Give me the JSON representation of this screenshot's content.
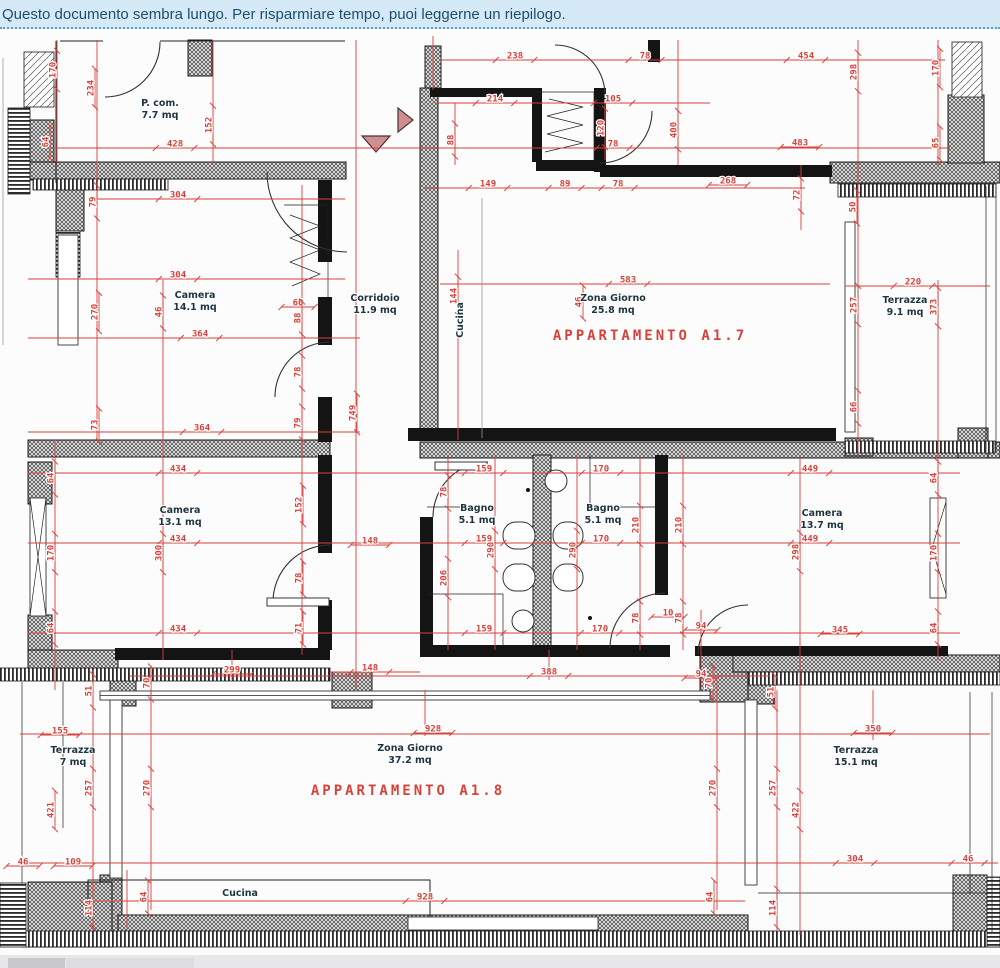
{
  "banner": {
    "text": "Questo documento sembra lungo. Per risparmiare tempo, puoi leggerne un riepilogo."
  },
  "colors": {
    "red": "#d9403a",
    "room_text": "#1d3540",
    "banner_bg": "#d6e9f7",
    "banner_text": "#1d4e6e",
    "banner_border": "#5b9fce",
    "triangle": "#cf8f8f"
  },
  "plan": {
    "apartments": [
      {
        "label": "APPARTAMENTO A1.7",
        "x": 650,
        "y": 340
      },
      {
        "label": "APPARTAMENTO A1.8",
        "x": 408,
        "y": 795
      }
    ],
    "rooms": [
      {
        "name": "P. com.",
        "area": "7.7 mq",
        "x": 160,
        "y": 106,
        "vert": false
      },
      {
        "name": "Camera",
        "area": "14.1 mq",
        "x": 195,
        "y": 298,
        "vert": false
      },
      {
        "name": "Corridoio",
        "area": "11.9 mq",
        "x": 375,
        "y": 301,
        "vert": false
      },
      {
        "name": "Cucina",
        "area": "",
        "x": 463,
        "y": 320,
        "vert": true
      },
      {
        "name": "Zona Giorno",
        "area": "25.8 mq",
        "x": 613,
        "y": 301,
        "vert": false
      },
      {
        "name": "Terrazza",
        "area": "9.1 mq",
        "x": 905,
        "y": 303,
        "vert": false
      },
      {
        "name": "Camera",
        "area": "13.1 mq",
        "x": 180,
        "y": 513,
        "vert": false
      },
      {
        "name": "Bagno",
        "area": "5.1 mq",
        "x": 477,
        "y": 511,
        "vert": false
      },
      {
        "name": "Bagno",
        "area": "5.1 mq",
        "x": 603,
        "y": 511,
        "vert": false
      },
      {
        "name": "Camera",
        "area": "13.7 mq",
        "x": 822,
        "y": 516,
        "vert": false
      },
      {
        "name": "Terrazza",
        "area": "7 mq",
        "x": 73,
        "y": 753,
        "vert": false
      },
      {
        "name": "Zona Giorno",
        "area": "37.2 mq",
        "x": 410,
        "y": 751,
        "vert": false
      },
      {
        "name": "Terrazza",
        "area": "15.1 mq",
        "x": 856,
        "y": 753,
        "vert": false
      },
      {
        "name": "Cucina",
        "area": "",
        "x": 240,
        "y": 896,
        "vert": false
      }
    ],
    "dims": [
      {
        "v": "170",
        "x": 57,
        "y": 70,
        "r": 90
      },
      {
        "v": "234",
        "x": 95,
        "y": 88,
        "r": 90
      },
      {
        "v": "152",
        "x": 213,
        "y": 125,
        "r": 90
      },
      {
        "v": "428",
        "x": 175,
        "y": 148,
        "r": 0
      },
      {
        "v": "64",
        "x": 50,
        "y": 142,
        "r": 90
      },
      {
        "v": "304",
        "x": 178,
        "y": 199,
        "r": 0
      },
      {
        "v": "79",
        "x": 97,
        "y": 202,
        "r": 90
      },
      {
        "v": "238",
        "x": 515,
        "y": 60,
        "r": 0
      },
      {
        "v": "78",
        "x": 645,
        "y": 60,
        "r": 0
      },
      {
        "v": "214",
        "x": 495,
        "y": 103,
        "r": 0
      },
      {
        "v": "105",
        "x": 613,
        "y": 103,
        "r": 0
      },
      {
        "v": "88",
        "x": 455,
        "y": 140,
        "r": 90
      },
      {
        "v": "120",
        "x": 605,
        "y": 128,
        "r": 90
      },
      {
        "v": "78",
        "x": 613,
        "y": 148,
        "r": 0
      },
      {
        "v": "149",
        "x": 488,
        "y": 188,
        "r": 0
      },
      {
        "v": "89",
        "x": 565,
        "y": 188,
        "r": 0
      },
      {
        "v": "78",
        "x": 618,
        "y": 188,
        "r": 0
      },
      {
        "v": "454",
        "x": 806,
        "y": 60,
        "r": 0
      },
      {
        "v": "298",
        "x": 858,
        "y": 72,
        "r": 90
      },
      {
        "v": "170",
        "x": 940,
        "y": 68,
        "r": 90
      },
      {
        "v": "400",
        "x": 678,
        "y": 130,
        "r": 90
      },
      {
        "v": "483",
        "x": 800,
        "y": 147,
        "r": 0
      },
      {
        "v": "65",
        "x": 940,
        "y": 143,
        "r": 90
      },
      {
        "v": "268",
        "x": 728,
        "y": 185,
        "r": 0
      },
      {
        "v": "72",
        "x": 801,
        "y": 195,
        "r": 90
      },
      {
        "v": "50",
        "x": 857,
        "y": 207,
        "r": 90
      },
      {
        "v": "304",
        "x": 178,
        "y": 279,
        "r": 0
      },
      {
        "v": "270",
        "x": 99,
        "y": 312,
        "r": 90
      },
      {
        "v": "46",
        "x": 163,
        "y": 312,
        "r": 90
      },
      {
        "v": "60",
        "x": 298,
        "y": 307,
        "r": 0
      },
      {
        "v": "88",
        "x": 302,
        "y": 318,
        "r": 90
      },
      {
        "v": "364",
        "x": 200,
        "y": 338,
        "r": 0
      },
      {
        "v": "78",
        "x": 302,
        "y": 372,
        "r": 90
      },
      {
        "v": "79",
        "x": 302,
        "y": 423,
        "r": 90
      },
      {
        "v": "73",
        "x": 99,
        "y": 425,
        "r": 90
      },
      {
        "v": "364",
        "x": 202,
        "y": 432,
        "r": 0
      },
      {
        "v": "749",
        "x": 357,
        "y": 413,
        "r": 90
      },
      {
        "v": "583",
        "x": 628,
        "y": 284,
        "r": 0
      },
      {
        "v": "144",
        "x": 458,
        "y": 296,
        "r": 90
      },
      {
        "v": "46",
        "x": 583,
        "y": 302,
        "r": 90
      },
      {
        "v": "220",
        "x": 913,
        "y": 286,
        "r": 0
      },
      {
        "v": "257",
        "x": 858,
        "y": 305,
        "r": 90
      },
      {
        "v": "373",
        "x": 938,
        "y": 307,
        "r": 90
      },
      {
        "v": "66",
        "x": 858,
        "y": 407,
        "r": 90
      },
      {
        "v": "434",
        "x": 178,
        "y": 473,
        "r": 0
      },
      {
        "v": "64",
        "x": 55,
        "y": 478,
        "r": 90
      },
      {
        "v": "159",
        "x": 484,
        "y": 473,
        "r": 0
      },
      {
        "v": "170",
        "x": 601,
        "y": 473,
        "r": 0
      },
      {
        "v": "449",
        "x": 810,
        "y": 473,
        "r": 0
      },
      {
        "v": "64",
        "x": 938,
        "y": 478,
        "r": 90
      },
      {
        "v": "78",
        "x": 448,
        "y": 492,
        "r": 90
      },
      {
        "v": "152",
        "x": 303,
        "y": 505,
        "r": 90
      },
      {
        "v": "210",
        "x": 640,
        "y": 525,
        "r": 90
      },
      {
        "v": "210",
        "x": 683,
        "y": 525,
        "r": 90
      },
      {
        "v": "434",
        "x": 178,
        "y": 543,
        "r": 0
      },
      {
        "v": "300",
        "x": 163,
        "y": 553,
        "r": 90
      },
      {
        "v": "170",
        "x": 55,
        "y": 553,
        "r": 90
      },
      {
        "v": "159",
        "x": 484,
        "y": 543,
        "r": 0
      },
      {
        "v": "170",
        "x": 601,
        "y": 543,
        "r": 0
      },
      {
        "v": "290",
        "x": 495,
        "y": 550,
        "r": 90
      },
      {
        "v": "290",
        "x": 577,
        "y": 550,
        "r": 90
      },
      {
        "v": "449",
        "x": 810,
        "y": 543,
        "r": 0
      },
      {
        "v": "298",
        "x": 800,
        "y": 552,
        "r": 90
      },
      {
        "v": "170",
        "x": 938,
        "y": 553,
        "r": 90
      },
      {
        "v": "148",
        "x": 370,
        "y": 545,
        "r": 0
      },
      {
        "v": "206",
        "x": 448,
        "y": 578,
        "r": 90
      },
      {
        "v": "78",
        "x": 303,
        "y": 578,
        "r": 90
      },
      {
        "v": "71",
        "x": 303,
        "y": 628,
        "r": 90
      },
      {
        "v": "64",
        "x": 55,
        "y": 628,
        "r": 90
      },
      {
        "v": "434",
        "x": 178,
        "y": 633,
        "r": 0
      },
      {
        "v": "159",
        "x": 484,
        "y": 633,
        "r": 0
      },
      {
        "v": "170",
        "x": 600,
        "y": 633,
        "r": 0
      },
      {
        "v": "78",
        "x": 640,
        "y": 618,
        "r": 90
      },
      {
        "v": "10",
        "x": 668,
        "y": 617,
        "r": 0
      },
      {
        "v": "78",
        "x": 683,
        "y": 618,
        "r": 90
      },
      {
        "v": "64",
        "x": 938,
        "y": 628,
        "r": 90
      },
      {
        "v": "94",
        "x": 701,
        "y": 630,
        "r": 0
      },
      {
        "v": "345",
        "x": 840,
        "y": 634,
        "r": 0
      },
      {
        "v": "299",
        "x": 232,
        "y": 674,
        "r": 0
      },
      {
        "v": "148",
        "x": 370,
        "y": 672,
        "r": 0
      },
      {
        "v": "388",
        "x": 549,
        "y": 676,
        "r": 0
      },
      {
        "v": "94",
        "x": 701,
        "y": 678,
        "r": 0
      },
      {
        "v": "51",
        "x": 93,
        "y": 691,
        "r": 90
      },
      {
        "v": "70",
        "x": 151,
        "y": 683,
        "r": 90
      },
      {
        "v": "70",
        "x": 713,
        "y": 683,
        "r": 90
      },
      {
        "v": "51",
        "x": 775,
        "y": 692,
        "r": 90
      },
      {
        "v": "155",
        "x": 60,
        "y": 735,
        "r": 0
      },
      {
        "v": "928",
        "x": 433,
        "y": 733,
        "r": 0
      },
      {
        "v": "350",
        "x": 873,
        "y": 733,
        "r": 0
      },
      {
        "v": "257",
        "x": 93,
        "y": 788,
        "r": 90
      },
      {
        "v": "270",
        "x": 151,
        "y": 788,
        "r": 90
      },
      {
        "v": "421",
        "x": 55,
        "y": 810,
        "r": 90
      },
      {
        "v": "270",
        "x": 717,
        "y": 788,
        "r": 90
      },
      {
        "v": "257",
        "x": 777,
        "y": 788,
        "r": 90
      },
      {
        "v": "422",
        "x": 800,
        "y": 810,
        "r": 90
      },
      {
        "v": "46",
        "x": 23,
        "y": 866,
        "r": 0
      },
      {
        "v": "109",
        "x": 73,
        "y": 866,
        "r": 0
      },
      {
        "v": "304",
        "x": 855,
        "y": 863,
        "r": 0
      },
      {
        "v": "46",
        "x": 968,
        "y": 863,
        "r": 0
      },
      {
        "v": "64",
        "x": 148,
        "y": 897,
        "r": 90
      },
      {
        "v": "64",
        "x": 714,
        "y": 897,
        "r": 90
      },
      {
        "v": "928",
        "x": 425,
        "y": 901,
        "r": 0
      },
      {
        "v": "114",
        "x": 93,
        "y": 908,
        "r": 90
      },
      {
        "v": "114",
        "x": 777,
        "y": 908,
        "r": 90
      }
    ]
  }
}
